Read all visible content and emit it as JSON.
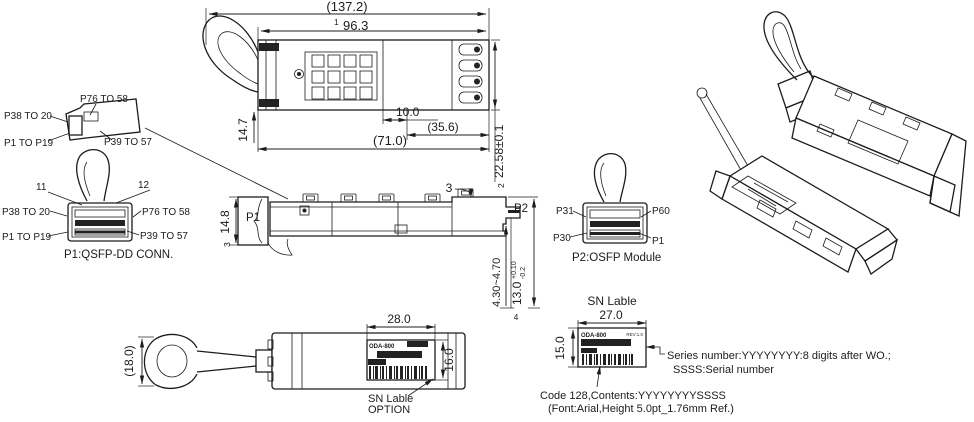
{
  "colors": {
    "line": "#1c1c1c",
    "background": "#ffffff",
    "accent_dark": "#222222"
  },
  "top_view": {
    "dim_overall_length": "(137.2)",
    "note_1": "1",
    "dim_body_length": "96.3",
    "dim_tab_width": "14.7",
    "dim_slot": "10.0",
    "dim_ref_356": "(35.6)",
    "dim_ref_710": "(71.0)",
    "note_2": "2",
    "dim_width": "22.58±0.1"
  },
  "plug_detail": {
    "label_top": "P76 TO 58",
    "label_left_upper": "P38 TO 20",
    "label_left_lower": "P1 TO P19",
    "label_right": "P39 TO 57"
  },
  "p1_connector": {
    "pin_11": "11",
    "pin_12": "12",
    "label_left_upper": "P38 TO 20",
    "label_right_upper": "P76 TO 58",
    "label_left_lower": "P1 TO P19",
    "label_right_lower": "P39 TO 57",
    "caption": "P1:QSFP-DD CONN."
  },
  "side_view": {
    "port_left": "P1",
    "note_3": "3",
    "dim_height_left": "14.8",
    "balloon": "3",
    "port_right": "P2",
    "dim_nose_range": "4.30~4.70",
    "dim_body_height": "13.0",
    "tolerance_plus": "+0.10",
    "tolerance_minus": "-0.2",
    "note_4": "4"
  },
  "p2_connector": {
    "label_left_upper": "P31",
    "label_right_upper": "P60",
    "label_left_lower": "P30",
    "label_right_lower": "P1",
    "caption": "P2:OSFP Module"
  },
  "bottom_view": {
    "dim_tab_height": "(18.0)",
    "dim_label_width": "28.0",
    "dim_label_height": "16.0",
    "sticker_model": "ODA-800",
    "callout_line1": "SN Lable",
    "callout_line2": "OPTION"
  },
  "sn_label_detail": {
    "title": "SN Lable",
    "dim_width": "27.0",
    "dim_height": "15.0",
    "sticker_model": "ODA-800",
    "sticker_rev": "REV:1.0",
    "note_series_line1": "Series number:YYYYYYYY:8 digits after WO.;",
    "note_series_line2": "SSSS:Serial number",
    "note_code_line1": "Code 128,Contents:YYYYYYYYSSSS",
    "note_code_line2": "(Font:Arial,Height 5.0pt_1.76mm Ref.)"
  }
}
